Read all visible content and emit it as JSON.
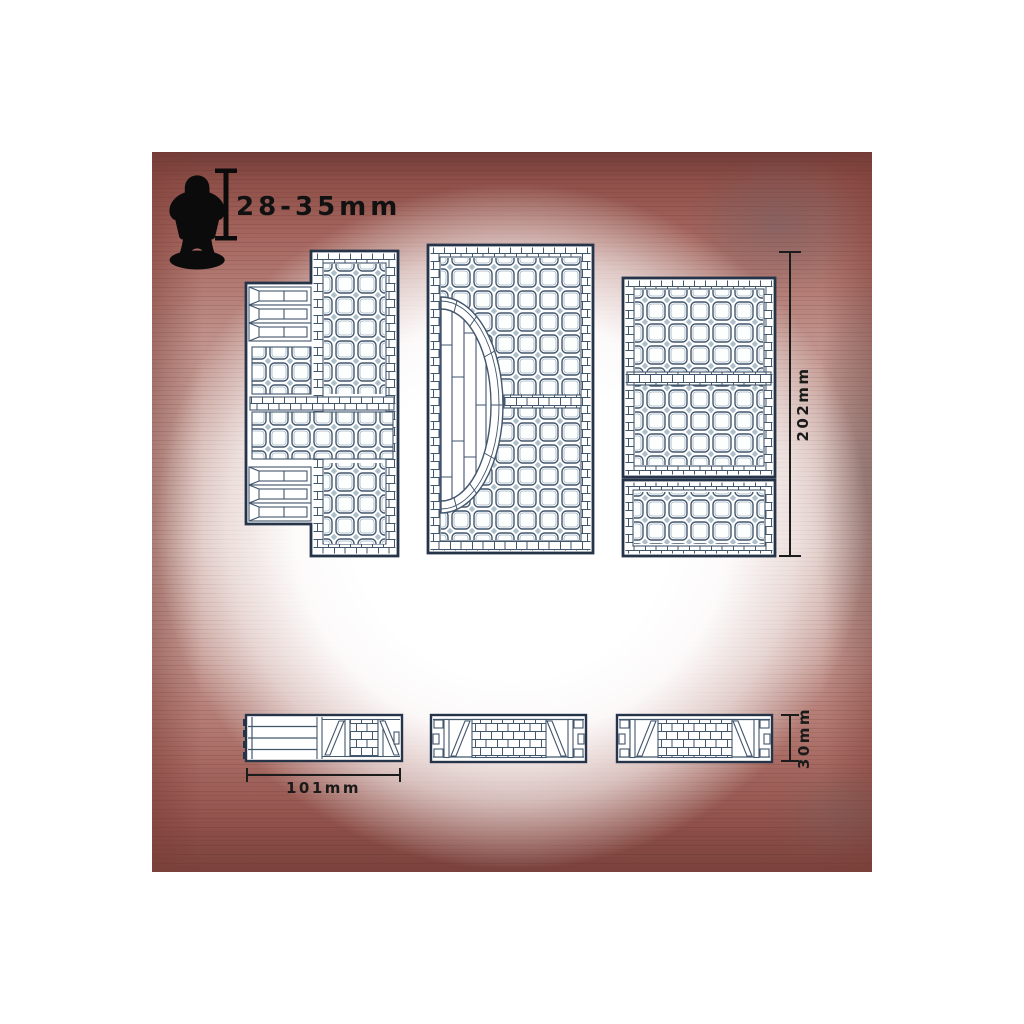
{
  "image": {
    "subject": "scale diagram of modular dungeon floor tiles and wall strips on red wood background"
  },
  "scale_indicator": {
    "figure_icon": "miniature-figure-silhouette",
    "bar_icon": "height-scale-bar",
    "label": "28-35mm"
  },
  "dimensions": {
    "tile_height": "202mm",
    "wall_length": "101mm",
    "wall_height": "30mm"
  },
  "drawings": {
    "top_row": [
      {
        "name": "l-shaped-floor-tile-with-stairs"
      },
      {
        "name": "floor-tile-with-curved-stone-arc-and-planks"
      },
      {
        "name": "rectangular-floor-tile-pair"
      }
    ],
    "bottom_row": [
      {
        "name": "wall-strip-with-plank-stairs-side"
      },
      {
        "name": "timber-framed-brick-wall-strip"
      },
      {
        "name": "timber-framed-brick-wall-strip"
      }
    ]
  },
  "colors": {
    "line_heavy": "#26344a",
    "line_mid": "#42566c",
    "mortar": "#aebfcc",
    "dimension_text": "#1a1a1a",
    "wood_dark": "#713c38",
    "wood_light": "#d2b1aa",
    "background": "#ffffff"
  }
}
